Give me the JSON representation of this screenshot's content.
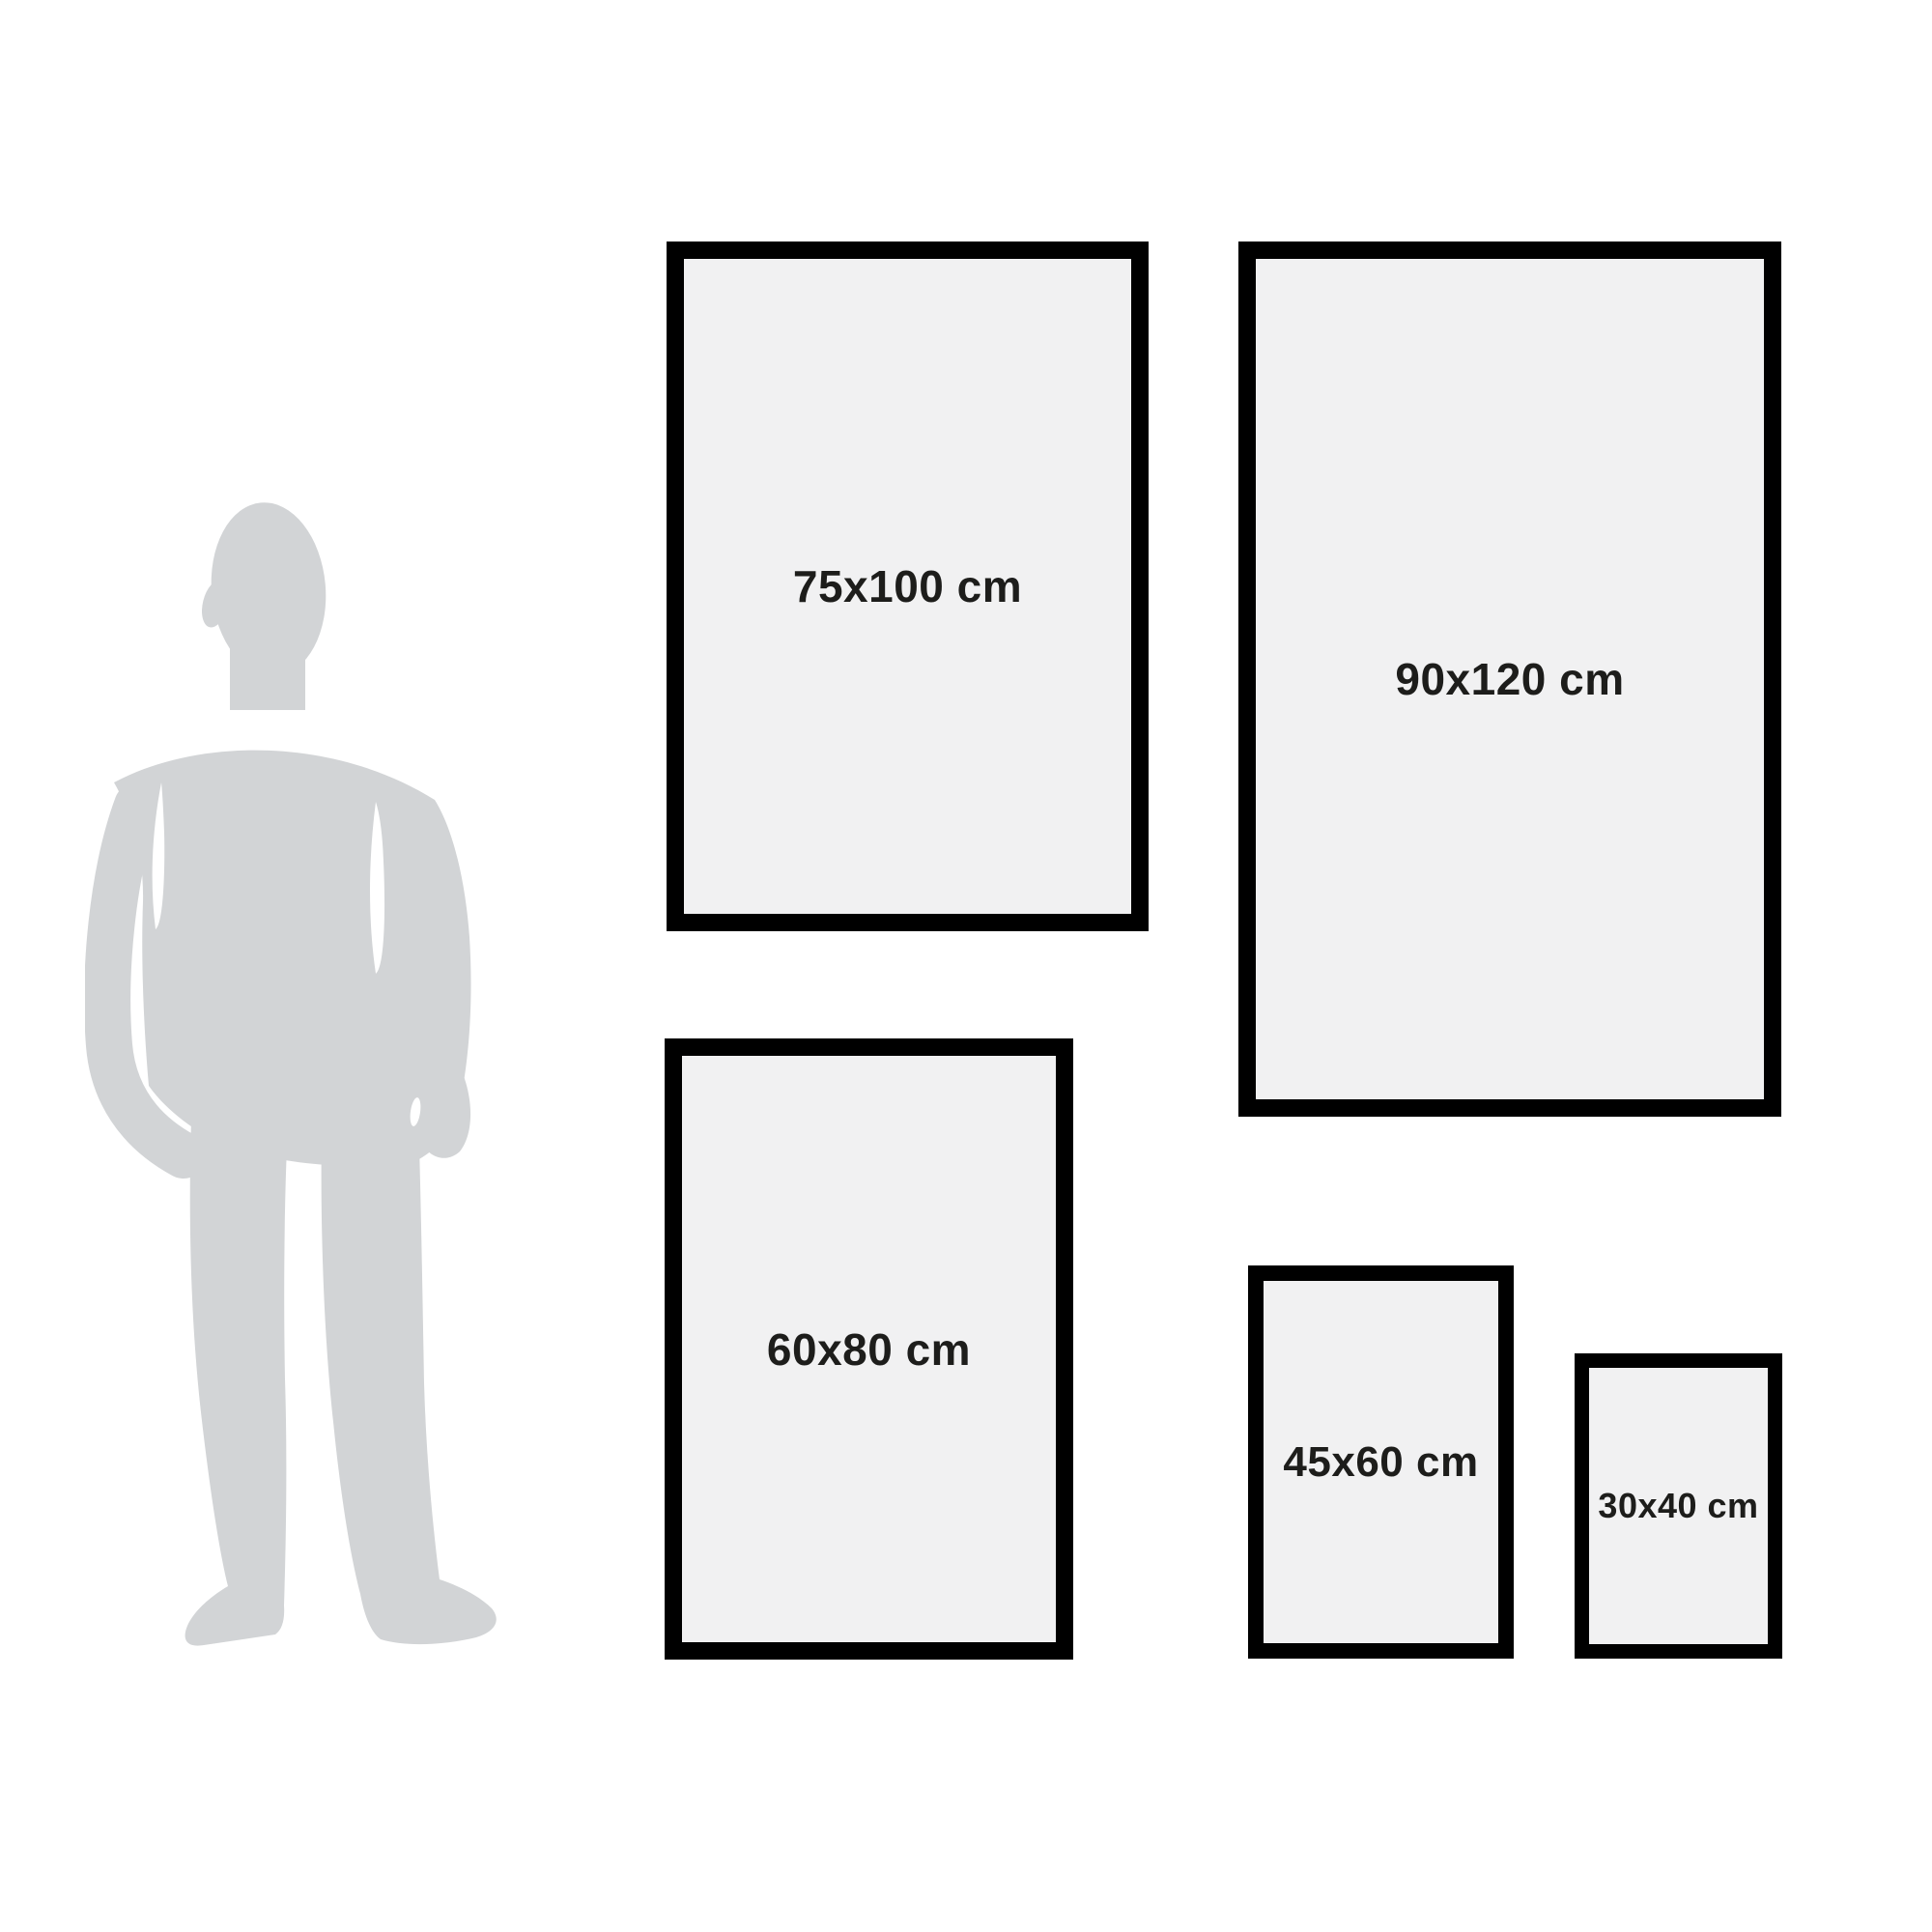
{
  "unit": "cm",
  "frames": [
    {
      "id": "75x100",
      "label": "75x100 cm",
      "width_cm": 75,
      "height_cm": 100
    },
    {
      "id": "90x120",
      "label": "90x120 cm",
      "width_cm": 90,
      "height_cm": 120
    },
    {
      "id": "60x80",
      "label": "60x80 cm",
      "width_cm": 60,
      "height_cm": 80
    },
    {
      "id": "45x60",
      "label": "45x60 cm",
      "width_cm": 45,
      "height_cm": 60
    },
    {
      "id": "30x40",
      "label": "30x40 cm",
      "width_cm": 30,
      "height_cm": 40
    }
  ],
  "colors": {
    "background": "#ffffff",
    "frame_border": "#000000",
    "frame_fill": "#f1f1f2",
    "silhouette": "#d2d4d6",
    "label_text": "#1d1d1b"
  }
}
